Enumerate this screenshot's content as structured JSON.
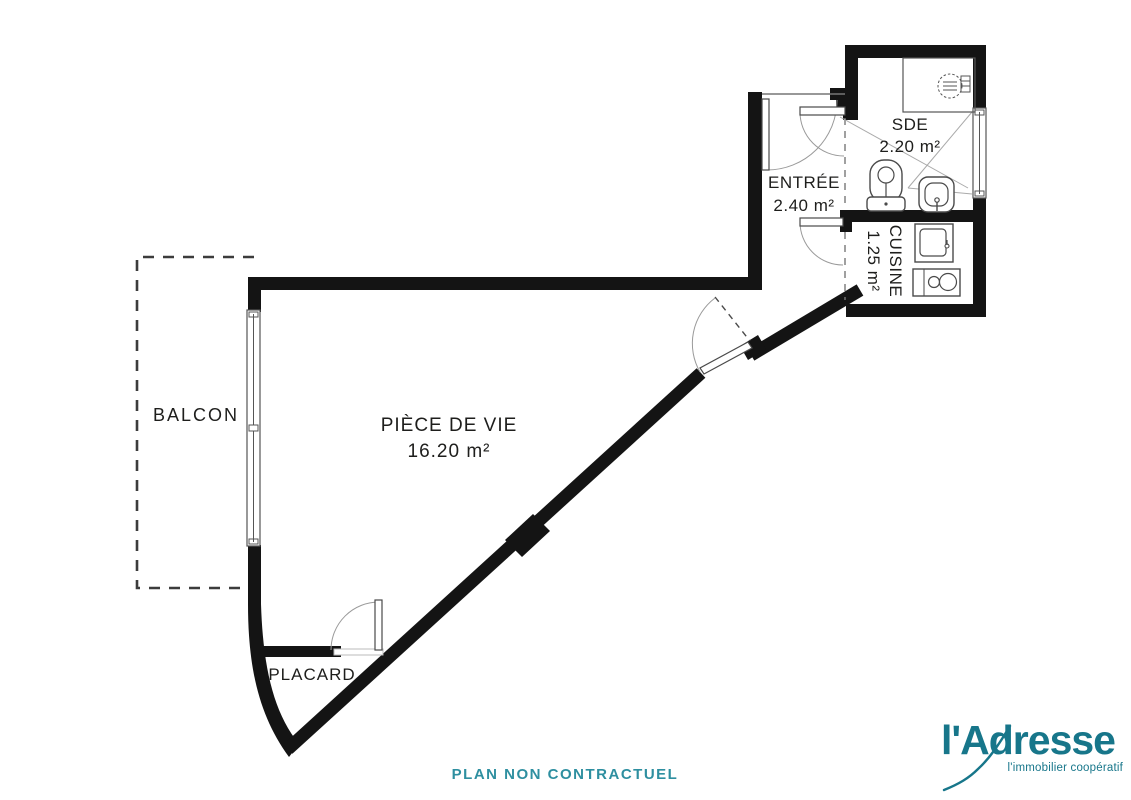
{
  "plan": {
    "disclaimer": "PLAN NON CONTRACTUEL",
    "rooms": {
      "balcon": {
        "label": "BALCON"
      },
      "piece_de_vie": {
        "label": "PIÈCE DE VIE",
        "area": "16.20 m²"
      },
      "entree": {
        "label": "ENTRÉE",
        "area": "2.40 m²"
      },
      "sde": {
        "label": "SDE",
        "area": "2.20 m²"
      },
      "cuisine": {
        "label": "CUISINE",
        "area": "1.25 m²"
      },
      "placard": {
        "label": "PLACARD"
      }
    },
    "fixtures": [
      "shower",
      "toilet",
      "washbasin",
      "kitchen-sink",
      "cooktop"
    ],
    "colors": {
      "wall": "#141414",
      "fixture_line": "#4a4a4a",
      "arc_line": "#9a9a9a",
      "disclaimer_teal": "#2e8fa0"
    }
  },
  "branding": {
    "logo_text": "l'Adresse",
    "tagline": "l'immobilier coopératif",
    "logo_color": "#17768a"
  }
}
